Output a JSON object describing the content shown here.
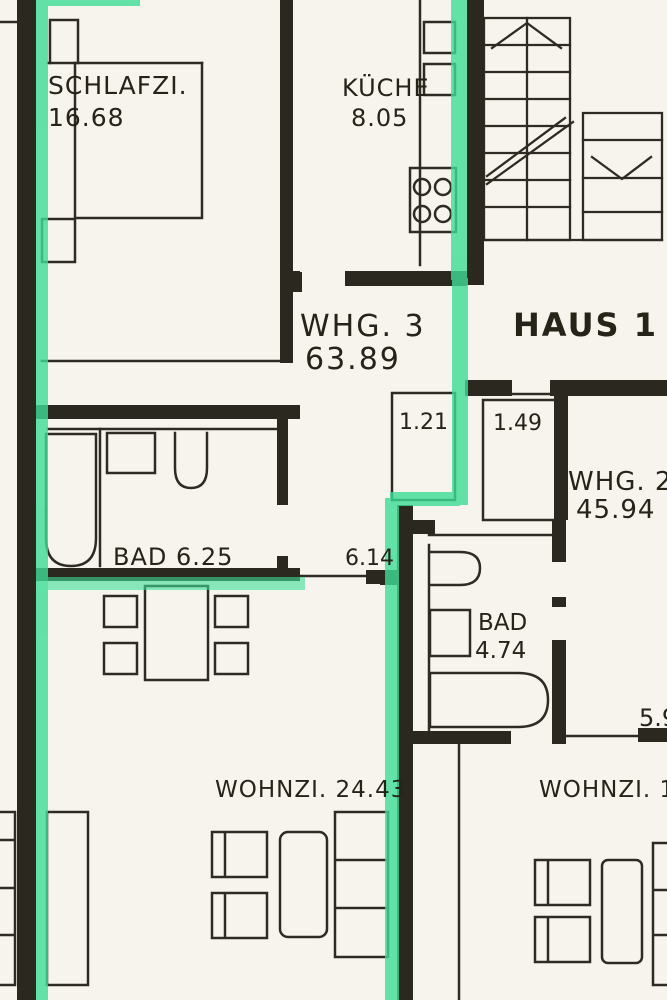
{
  "colors": {
    "background": "#f6f4ec",
    "wall": "#2b2820",
    "line": "#2e2b23",
    "highlight": "#3edd97",
    "text": "#262419"
  },
  "building": {
    "house_label": "HAUS 1"
  },
  "apartment_3": {
    "label": "WHG. 3",
    "area": "63.89",
    "bedroom_label": "SCHLAFZI.",
    "bedroom_area": "16.68",
    "kitchen_label": "KÜCHE",
    "kitchen_area": "8.05",
    "bath_label": "BAD 6.25",
    "hall_dim": "6.14",
    "wc_dim": "1.21",
    "living_label": "WOHNZI. 24.43"
  },
  "apartment_2": {
    "label": "WHG. 2",
    "area": "45.94",
    "bath_label": "BAD",
    "bath_area": "4.74",
    "entry_dim": "1.49",
    "edge_dim": "5.9",
    "living_label": "WOHNZI. 17."
  }
}
